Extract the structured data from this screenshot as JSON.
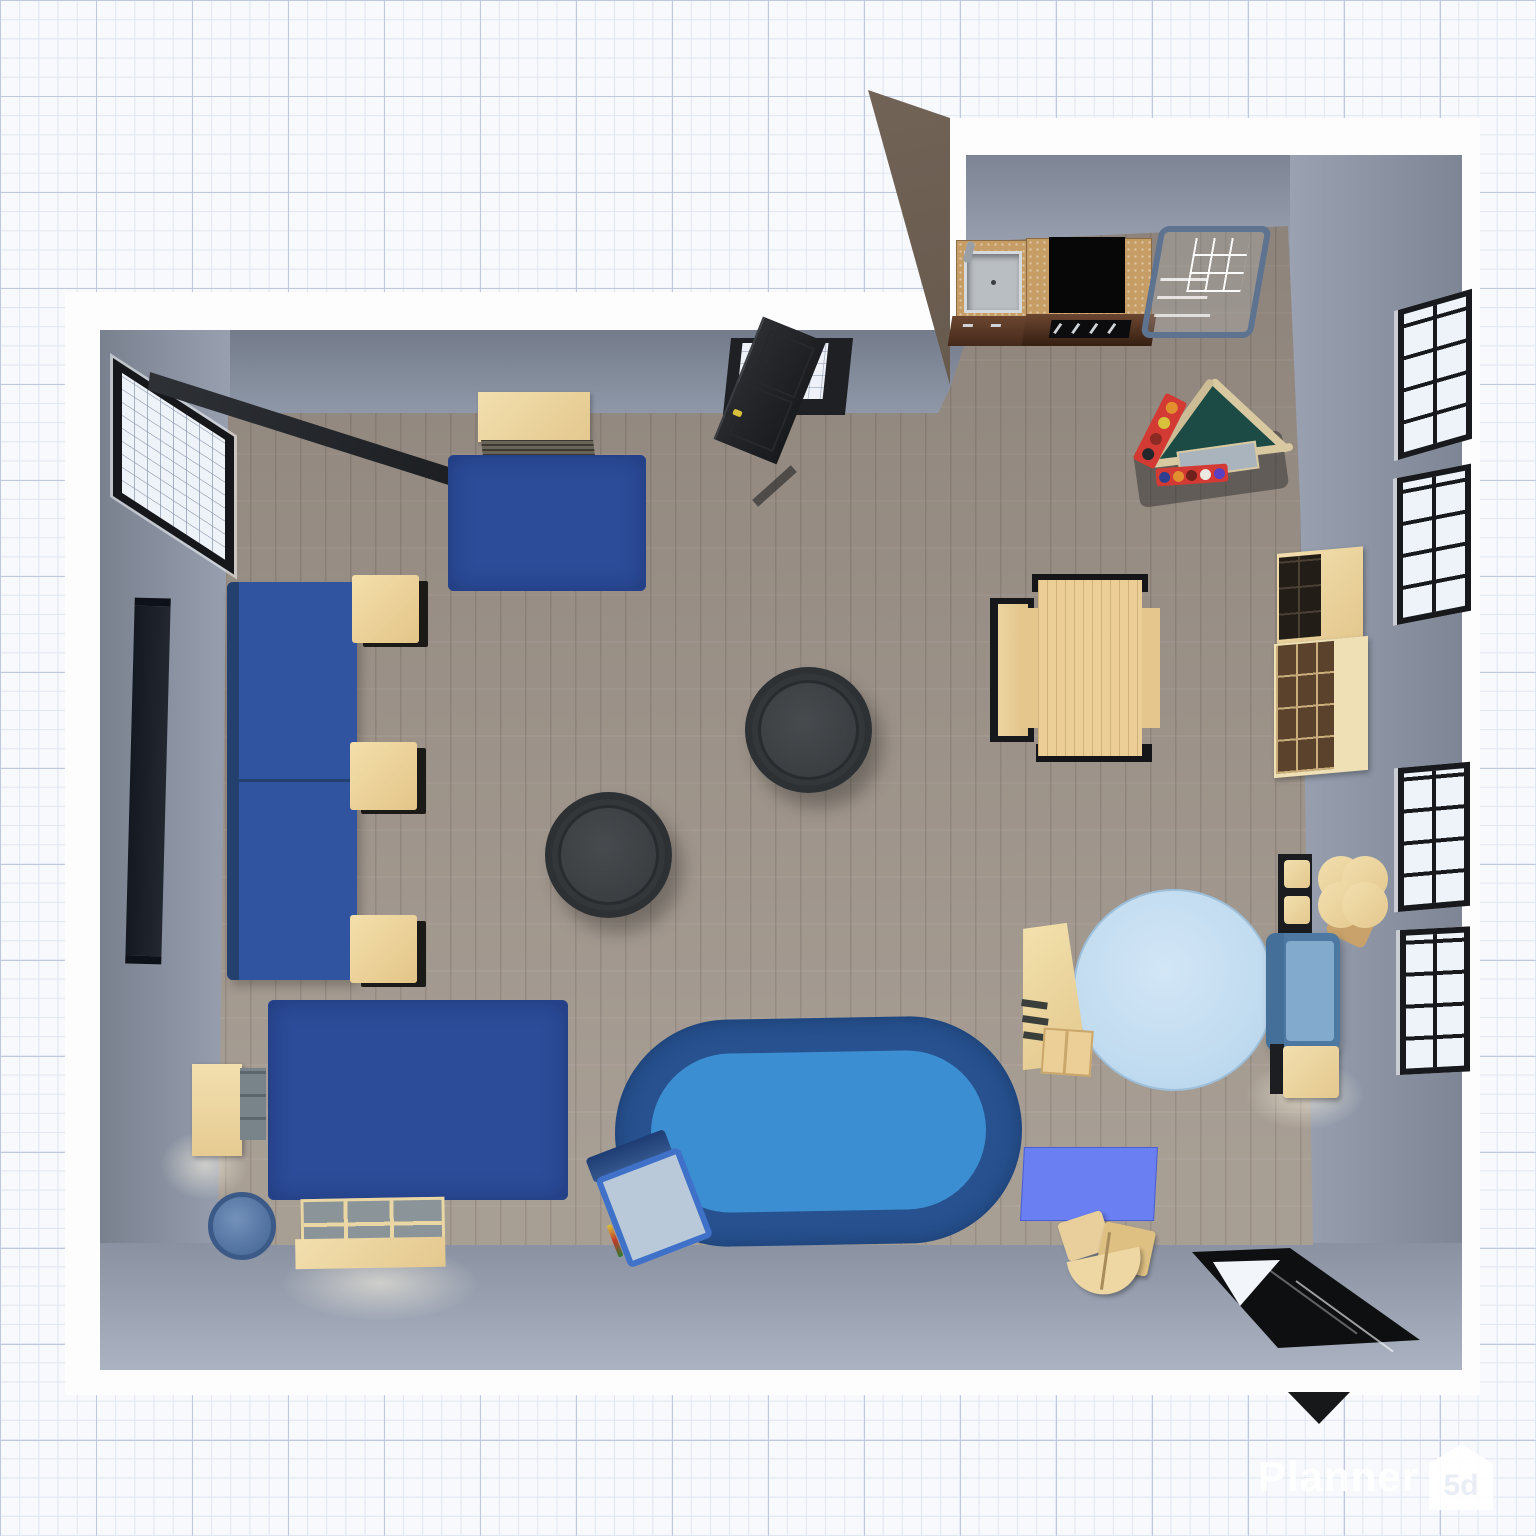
{
  "app": {
    "watermark": {
      "text": "Planner",
      "logo_text": "5d",
      "icon": "house-logo-icon"
    }
  },
  "palette": {
    "grid_background": "#f7f9fc",
    "wall_outline_white": "#fdfdfd",
    "wall_gray": "#8f97a7",
    "floor_wood": "#9d948b",
    "partition_brown": "#5e5146",
    "rug_blue": "#2c4c99",
    "oval_rug_outer": "#27528f",
    "oval_rug_inner": "#3c8ed2",
    "round_rug_light_blue": "#c6dff2",
    "sofa_blue": "#30549f",
    "loveseat_blue": "#4c78a2",
    "mat_blue_violet": "#6a7ff2",
    "wood_cream": "#ecd29a",
    "counter_top_tan": "#c79d66",
    "cabinet_front_brown": "#5d3a26",
    "cooktop_black": "#070708",
    "pouf_charcoal": "#3a3e41",
    "door_black": "#232528",
    "accent_red": "#d23a33",
    "accent_teal": "#1c4a44"
  },
  "scene": {
    "view": "top-down 3D floor plan render",
    "rooms": [
      {
        "name": "living-playroom"
      },
      {
        "name": "kitchen-nook"
      }
    ],
    "objects": [
      {
        "name": "left-wall-window",
        "type": "window, sash open"
      },
      {
        "name": "tv-panel",
        "type": "wall-mounted screen"
      },
      {
        "name": "sofa-left",
        "type": "two-seat sofa, blue"
      },
      {
        "name": "side-table-1",
        "type": "square table, cream"
      },
      {
        "name": "side-table-2",
        "type": "square table, cream"
      },
      {
        "name": "side-table-3",
        "type": "square table, cream"
      },
      {
        "name": "rug-top",
        "type": "rectangular rug, blue"
      },
      {
        "name": "sideboard-top",
        "type": "cabinet, cream"
      },
      {
        "name": "door-top",
        "type": "door, black, open"
      },
      {
        "name": "pouf-1",
        "type": "round pouf, charcoal"
      },
      {
        "name": "pouf-2",
        "type": "round pouf, charcoal"
      },
      {
        "name": "rug-bottom-left",
        "type": "rectangular rug, blue"
      },
      {
        "name": "wall-shelf-left",
        "type": "open shelf, cream"
      },
      {
        "name": "storage-bin",
        "type": "round bin, blue"
      },
      {
        "name": "toy-box",
        "type": "compartment storage box, cream"
      },
      {
        "name": "oval-rug",
        "type": "oval rug, two-tone blue"
      },
      {
        "name": "kids-chair",
        "type": "child chair, blue frame"
      },
      {
        "name": "dining-bench",
        "type": "bench, cream"
      },
      {
        "name": "dining-table",
        "type": "table, cream with dark ends"
      },
      {
        "name": "kitchen-sink-unit",
        "type": "counter with steel sink"
      },
      {
        "name": "kitchen-stove-unit",
        "type": "counter with black cooktop"
      },
      {
        "name": "wire-rack",
        "type": "metal shelving rack"
      },
      {
        "name": "play-triangle",
        "type": "kids climbing triangle with abacus beads"
      },
      {
        "name": "wardrobe-cube-shelf",
        "type": "wardrobe + cube organizer"
      },
      {
        "name": "round-rug",
        "type": "round rug, light blue"
      },
      {
        "name": "kids-bookshelf",
        "type": "kids shelf, cream"
      },
      {
        "name": "clover-table-set",
        "type": "kids clover table with chairs"
      },
      {
        "name": "loveseat",
        "type": "loveseat, blue"
      },
      {
        "name": "side-table-right",
        "type": "square table, cream"
      },
      {
        "name": "play-mat",
        "type": "mat, blue-violet"
      },
      {
        "name": "wooden-toy",
        "type": "wooden toy cluster, cream"
      },
      {
        "name": "door-bottom",
        "type": "door, black, open"
      },
      {
        "name": "right-wall-windows",
        "type": "4 grid windows, black frames"
      }
    ]
  }
}
